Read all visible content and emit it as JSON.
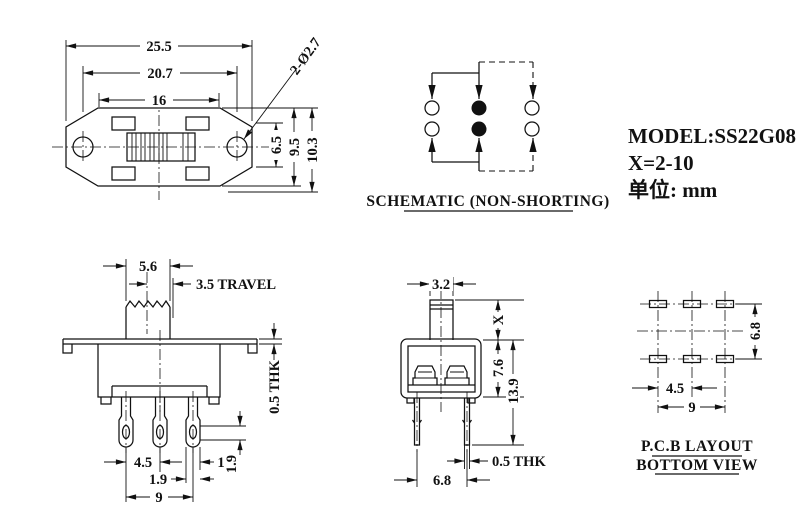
{
  "colors": {
    "ink": "#111111",
    "background": "#ffffff"
  },
  "views": {
    "top": {
      "dims": {
        "overall": "25.5",
        "holes_span": "20.7",
        "inner": "16",
        "hole_callout": "2-Ø2.7",
        "slot_h": "6.5",
        "body_h": "9.5",
        "total_h": "10.3"
      }
    },
    "schematic": {
      "caption": "SCHEMATIC (NON-SHORTING)"
    },
    "info": {
      "model": "MODEL:SS22G08",
      "x_range": "X=2-10",
      "unit": "单位: mm"
    },
    "front": {
      "dims": {
        "knob_w": "5.6",
        "travel": "3.5 TRAVEL",
        "flange_thk": "0.5 THK",
        "pin_pitch": "4.5",
        "pin_edge": "1",
        "pin_w": "1.9",
        "hole_h": "1.9",
        "span": "9"
      }
    },
    "side": {
      "dims": {
        "knob_w": "3.2",
        "knob_h": "X",
        "body_h": "7.6",
        "total_h": "13.9",
        "pin_thk": "0.5 THK",
        "pin_pitch": "6.8"
      }
    },
    "pcb": {
      "dims": {
        "row_pitch": "6.8",
        "col_pitch": "4.5",
        "span": "9"
      },
      "caption_line1": "P.C.B LAYOUT",
      "caption_line2": "BOTTOM VIEW"
    }
  }
}
